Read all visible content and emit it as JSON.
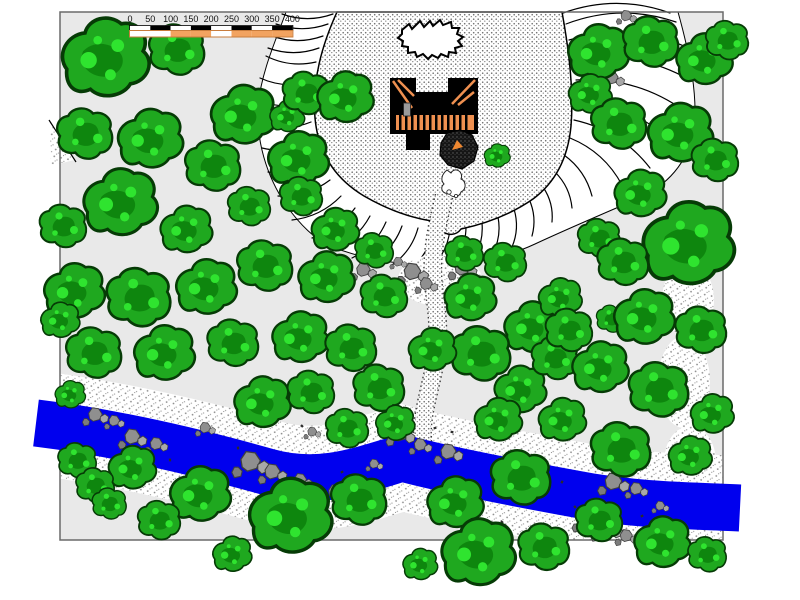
{
  "page": {
    "background": "#ffffff"
  },
  "map": {
    "border_color": "#6a6a6a",
    "ground_color": "#e9e9e9",
    "scale_bar": {
      "tick_labels": [
        "0",
        "50",
        "100",
        "150",
        "200",
        "250",
        "300",
        "350",
        "400"
      ],
      "units_per_tick": 50,
      "top_row_colors": [
        "#ffffff",
        "#000000",
        "#ffffff",
        "#000000",
        "#ffffff",
        "#000000",
        "#ffffff",
        "#000000"
      ],
      "bottom_row_colors": [
        "#ffffff",
        "#ffffff",
        "#f2a360",
        "#f2a360",
        "#ffffff",
        "#f2a360",
        "#f2a360",
        "#f2a360"
      ],
      "top_row_border": "#000000",
      "bottom_row_border": "#c87c3c",
      "text_color": "#111111"
    },
    "palette": {
      "tree_body": "#1fa81f",
      "tree_shadow": "#0e860e",
      "tree_light": "#2fe42f",
      "tree_outline": "#063b06",
      "river": "#0000ee",
      "rock": "#8f8f8f",
      "rock_outline": "#3f3f3f",
      "castle": "#000000",
      "castle_roof": "#ef9050",
      "door": "#9a9a9a",
      "hachure": "#000000",
      "mound_accent": "#f08830"
    },
    "features": {
      "trees": [
        [
          105,
          62,
          40,
          0
        ],
        [
          178,
          52,
          26,
          1
        ],
        [
          243,
          118,
          30,
          0
        ],
        [
          86,
          136,
          26,
          1
        ],
        [
          150,
          142,
          30,
          0
        ],
        [
          214,
          168,
          26,
          1
        ],
        [
          120,
          206,
          34,
          0
        ],
        [
          64,
          228,
          22,
          1
        ],
        [
          186,
          232,
          24,
          0
        ],
        [
          250,
          208,
          20,
          1
        ],
        [
          287,
          118,
          16,
          0
        ],
        [
          307,
          95,
          22,
          1
        ],
        [
          345,
          100,
          26,
          0
        ],
        [
          298,
          162,
          28,
          0
        ],
        [
          302,
          198,
          20,
          1
        ],
        [
          335,
          232,
          22,
          0
        ],
        [
          375,
          252,
          18,
          1
        ],
        [
          74,
          294,
          28,
          0
        ],
        [
          140,
          300,
          30,
          1
        ],
        [
          206,
          290,
          28,
          0
        ],
        [
          266,
          268,
          26,
          1
        ],
        [
          326,
          280,
          26,
          0
        ],
        [
          385,
          298,
          22,
          1
        ],
        [
          60,
          322,
          18,
          0
        ],
        [
          95,
          355,
          26,
          1
        ],
        [
          164,
          356,
          28,
          0
        ],
        [
          234,
          345,
          24,
          1
        ],
        [
          300,
          340,
          26,
          0
        ],
        [
          352,
          350,
          24,
          1
        ],
        [
          262,
          405,
          26,
          0
        ],
        [
          312,
          394,
          22,
          1
        ],
        [
          70,
          396,
          14,
          0
        ],
        [
          78,
          462,
          18,
          1
        ],
        [
          132,
          470,
          22,
          0
        ],
        [
          96,
          487,
          18,
          1
        ],
        [
          200,
          497,
          28,
          0
        ],
        [
          160,
          522,
          20,
          1
        ],
        [
          290,
          520,
          38,
          0
        ],
        [
          360,
          502,
          26,
          1
        ],
        [
          232,
          556,
          18,
          0
        ],
        [
          110,
          505,
          16,
          1
        ],
        [
          470,
          300,
          24,
          0
        ],
        [
          506,
          264,
          20,
          1
        ],
        [
          532,
          330,
          26,
          0
        ],
        [
          482,
          356,
          28,
          1
        ],
        [
          432,
          352,
          22,
          0
        ],
        [
          380,
          390,
          24,
          1
        ],
        [
          520,
          392,
          24,
          0
        ],
        [
          556,
          360,
          22,
          1
        ],
        [
          498,
          422,
          22,
          0
        ],
        [
          348,
          430,
          20,
          1
        ],
        [
          395,
          425,
          18,
          0
        ],
        [
          465,
          255,
          18,
          1
        ],
        [
          560,
          300,
          20,
          0
        ],
        [
          497,
          157,
          12,
          0
        ],
        [
          612,
          320,
          14,
          1
        ],
        [
          455,
          505,
          26,
          0
        ],
        [
          522,
          480,
          28,
          1
        ],
        [
          478,
          556,
          34,
          0
        ],
        [
          545,
          549,
          24,
          1
        ],
        [
          420,
          566,
          16,
          0
        ],
        [
          600,
          522,
          22,
          1
        ],
        [
          598,
          55,
          28,
          0
        ],
        [
          652,
          44,
          26,
          1
        ],
        [
          704,
          62,
          26,
          0
        ],
        [
          728,
          42,
          20,
          1
        ],
        [
          590,
          96,
          20,
          0
        ],
        [
          620,
          126,
          26,
          1
        ],
        [
          680,
          136,
          30,
          0
        ],
        [
          716,
          162,
          22,
          1
        ],
        [
          640,
          196,
          24,
          0
        ],
        [
          600,
          240,
          20,
          1
        ],
        [
          688,
          248,
          42,
          0
        ],
        [
          624,
          264,
          24,
          1
        ],
        [
          644,
          320,
          28,
          0
        ],
        [
          702,
          332,
          24,
          1
        ],
        [
          600,
          370,
          26,
          0
        ],
        [
          660,
          392,
          28,
          1
        ],
        [
          712,
          416,
          20,
          0
        ],
        [
          570,
          332,
          22,
          1
        ],
        [
          562,
          422,
          22,
          0
        ],
        [
          622,
          452,
          28,
          1
        ],
        [
          690,
          458,
          20,
          0
        ],
        [
          662,
          545,
          26,
          0
        ],
        [
          708,
          556,
          18,
          1
        ]
      ],
      "rocks": [
        [
          412,
          272,
          1.1
        ],
        [
          426,
          284,
          0.8
        ],
        [
          462,
          268,
          1.0
        ],
        [
          472,
          281,
          0.7
        ],
        [
          500,
          258,
          0.6
        ],
        [
          398,
          262,
          0.6
        ],
        [
          363,
          270,
          0.9
        ],
        [
          626,
          16,
          0.7
        ],
        [
          611,
          78,
          0.9
        ],
        [
          95,
          415,
          0.9
        ],
        [
          114,
          421,
          0.7
        ],
        [
          132,
          437,
          1.0
        ],
        [
          156,
          444,
          0.8
        ],
        [
          205,
          428,
          0.7
        ],
        [
          250,
          462,
          1.3
        ],
        [
          272,
          472,
          1.0
        ],
        [
          300,
          480,
          0.8
        ],
        [
          335,
          492,
          0.9
        ],
        [
          312,
          432,
          0.6
        ],
        [
          400,
          434,
          1.0
        ],
        [
          420,
          445,
          0.8
        ],
        [
          448,
          452,
          1.0
        ],
        [
          352,
          508,
          0.7
        ],
        [
          374,
          464,
          0.6
        ],
        [
          613,
          482,
          1.1
        ],
        [
          636,
          489,
          0.8
        ],
        [
          586,
          520,
          1.0
        ],
        [
          606,
          528,
          1.1
        ],
        [
          626,
          536,
          0.8
        ],
        [
          660,
          506,
          0.6
        ]
      ],
      "flecks": [
        [
          90,
          456
        ],
        [
          106,
          472
        ],
        [
          182,
          482
        ],
        [
          222,
          502
        ],
        [
          342,
          472
        ],
        [
          382,
          506
        ],
        [
          502,
          522
        ],
        [
          542,
          472
        ],
        [
          562,
          482
        ],
        [
          642,
          516
        ],
        [
          452,
          432
        ],
        [
          302,
          426
        ],
        [
          238,
          448
        ],
        [
          275,
          492
        ],
        [
          355,
          477
        ],
        [
          525,
          500
        ],
        [
          575,
          507
        ],
        [
          170,
          460
        ],
        [
          128,
          452
        ],
        [
          435,
          428
        ]
      ],
      "hachures": [
        [
          333,
          14,
          282,
          14
        ],
        [
          328,
          24,
          276,
          24
        ],
        [
          323,
          36,
          272,
          36
        ],
        [
          319,
          48,
          268,
          48
        ],
        [
          316,
          62,
          266,
          56
        ],
        [
          312,
          82,
          260,
          78
        ],
        [
          310,
          102,
          257,
          100
        ],
        [
          311,
          122,
          258,
          124
        ],
        [
          315,
          142,
          262,
          148
        ],
        [
          321,
          162,
          268,
          172
        ],
        [
          330,
          180,
          278,
          196
        ],
        [
          341,
          196,
          292,
          220
        ],
        [
          355,
          208,
          312,
          238
        ],
        [
          370,
          216,
          332,
          250
        ],
        [
          386,
          222,
          352,
          258
        ],
        [
          402,
          226,
          372,
          262
        ],
        [
          418,
          228,
          392,
          265
        ],
        [
          434,
          229,
          412,
          267
        ],
        [
          450,
          229,
          432,
          267
        ],
        [
          466,
          227,
          452,
          265
        ],
        [
          482,
          223,
          472,
          261
        ],
        [
          498,
          217,
          492,
          255
        ],
        [
          514,
          209,
          512,
          247
        ],
        [
          529,
          199,
          532,
          236
        ],
        [
          543,
          187,
          552,
          222
        ],
        [
          555,
          172,
          572,
          208
        ],
        [
          564,
          155,
          592,
          196
        ],
        [
          570,
          138,
          622,
          185
        ],
        [
          574,
          120,
          650,
          168
        ],
        [
          576,
          100,
          672,
          142
        ],
        [
          576,
          80,
          686,
          112
        ],
        [
          573,
          60,
          690,
          80
        ],
        [
          569,
          40,
          684,
          46
        ],
        [
          566,
          24,
          676,
          22
        ],
        [
          563,
          13,
          670,
          13
        ]
      ]
    }
  }
}
